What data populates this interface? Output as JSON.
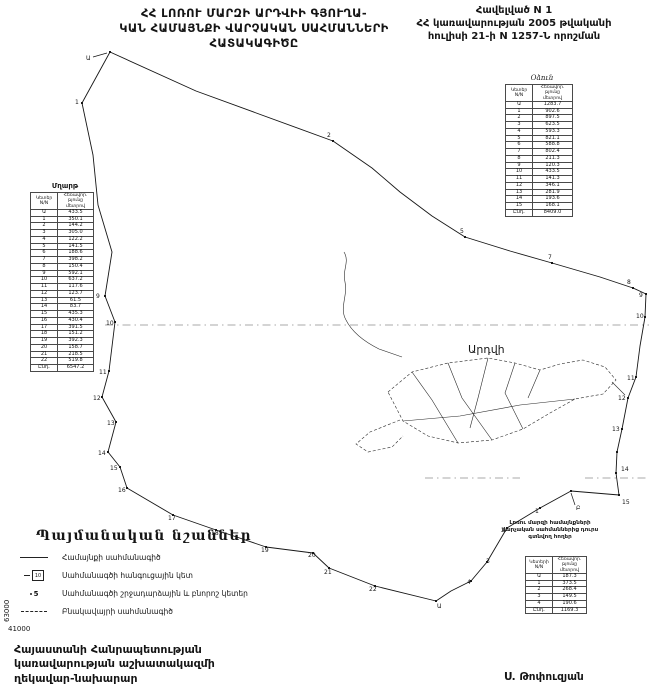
{
  "ink": "#161616",
  "title": {
    "line1": "ՀՀ ԼՈՌՈՒ ՄԱՐԶԻ ԱՐԴՎԻԻ ԳՅՈՒՂԱ-",
    "line2": "ԿԱՆ ՀԱՄԱՅՆՔԻ ՎԱՐՉԱԿԱՆ ՍԱՀՄԱՆՆԵՐԻ",
    "line3": "ՀԱՏԱԿԱԳԻԾԸ"
  },
  "annex": {
    "line1": "Հավելված N 1",
    "line2": "ՀՀ կառավարության 2005 թվականի",
    "line3": "հուլիսի 21-ի N 1257-Ն որոշման"
  },
  "left_table": {
    "title": "Մղարթ",
    "col1_lines": [
      "Կետեր",
      "N/N"
    ],
    "col2_lines": [
      "Հեռավոր.",
      "թյունը",
      "մետրով"
    ],
    "rows": [
      [
        "Ա",
        "433.5"
      ],
      [
        "1",
        "350.1"
      ],
      [
        "2",
        "144.2"
      ],
      [
        "3",
        "305.0"
      ],
      [
        "4",
        "122.2"
      ],
      [
        "5",
        "141.5"
      ],
      [
        "6",
        "188.6"
      ],
      [
        "7",
        "398.2"
      ],
      [
        "8",
        "150.4"
      ],
      [
        "9",
        "592.1"
      ],
      [
        "10",
        "637.2"
      ],
      [
        "11",
        "117.6"
      ],
      [
        "12",
        "123.7"
      ],
      [
        "13",
        "61.5"
      ],
      [
        "14",
        "83.7"
      ],
      [
        "15",
        "435.3"
      ],
      [
        "16",
        "430.4"
      ],
      [
        "17",
        "391.5"
      ],
      [
        "18",
        "151.2"
      ],
      [
        "19",
        "392.3"
      ],
      [
        "20",
        "158.7"
      ],
      [
        "21",
        "218.5"
      ],
      [
        "22",
        "519.8"
      ]
    ],
    "total_label": "Ընդ.",
    "total": "6547.2"
  },
  "right_table": {
    "title": "Օձուն",
    "col1_lines": [
      "Կետեր",
      "N/N"
    ],
    "col2_lines": [
      "Հեռավոր.",
      "թյունը",
      "մետրով"
    ],
    "rows": [
      [
        "Ա",
        "1283.7"
      ],
      [
        "1",
        "902.6"
      ],
      [
        "2",
        "897.5"
      ],
      [
        "3",
        "623.5"
      ],
      [
        "4",
        "593.3"
      ],
      [
        "5",
        "821.1"
      ],
      [
        "6",
        "588.8"
      ],
      [
        "7",
        "802.4"
      ],
      [
        "8",
        "211.3"
      ],
      [
        "9",
        "120.3"
      ],
      [
        "10",
        "433.5"
      ],
      [
        "11",
        "141.3"
      ],
      [
        "12",
        "346.1"
      ],
      [
        "13",
        "281.9"
      ],
      [
        "14",
        "193.6"
      ],
      [
        "15",
        "168.1"
      ]
    ],
    "total_label": "Ընդ.",
    "total": "8409.0"
  },
  "outside_table": {
    "caption_lines": [
      "Լոռու մարզի համայնքների",
      "վարչական սահմաններից դուրս",
      "գտնվող հողեր"
    ],
    "col1_lines": [
      "Կետերի",
      "N/N"
    ],
    "col2_lines": [
      "Հեռավոր.",
      "թյունը",
      "մետրով"
    ],
    "rows": [
      [
        "Ա",
        "187.3"
      ],
      [
        "1",
        "373.5"
      ],
      [
        "2",
        "268.4"
      ],
      [
        "3",
        "149.5"
      ],
      [
        "4",
        "190.6"
      ]
    ],
    "total_label": "Ընդ.",
    "total": "1169.3"
  },
  "legend": {
    "title": "Պայմանական նշաններ",
    "items": [
      {
        "symbol": "solid-line",
        "label": "Համայնքի սահմանագիծ"
      },
      {
        "symbol": "node-box",
        "number": "10",
        "label": "Սահմանագծի հանգուցային կետ"
      },
      {
        "symbol": "turn-point",
        "number": "5",
        "label": "Սահմանագծի շրջադարձային և բնորոշ կետեր"
      },
      {
        "symbol": "dashed-line",
        "label": "Բնակավայրի սահմանագիծ"
      }
    ]
  },
  "footer": {
    "line1": "Հայաստանի Հանրապետության",
    "line2": "կառավարության աշխատակազմի",
    "line3": "ղեկավար-նախարար",
    "signature": "Ս. Թոփուզյան"
  },
  "grid_labels": {
    "y": "63000",
    "x": "41000"
  },
  "map": {
    "settlement_label": "Արդվի",
    "settlement_label_pos": [
      468,
      353
    ],
    "boundary": [
      [
        110,
        52
      ],
      [
        196,
        91
      ],
      [
        333,
        141
      ],
      [
        372,
        168
      ],
      [
        400,
        192
      ],
      [
        432,
        216
      ],
      [
        465,
        237
      ],
      [
        510,
        251
      ],
      [
        552,
        263
      ],
      [
        600,
        277
      ],
      [
        633,
        288
      ],
      [
        646,
        294
      ],
      [
        645,
        317
      ],
      [
        640,
        346
      ],
      [
        636,
        377
      ],
      [
        628,
        398
      ],
      [
        622,
        429
      ],
      [
        617,
        452
      ],
      [
        616,
        473
      ],
      [
        619,
        495
      ],
      [
        571,
        491
      ],
      [
        540,
        508
      ],
      [
        507,
        528
      ],
      [
        497,
        545
      ],
      [
        487,
        562
      ],
      [
        471,
        581
      ],
      [
        451,
        591
      ],
      [
        436,
        601
      ],
      [
        375,
        586
      ],
      [
        329,
        568
      ],
      [
        313,
        553
      ],
      [
        266,
        547
      ],
      [
        216,
        530
      ],
      [
        173,
        515
      ],
      [
        127,
        488
      ],
      [
        120,
        467
      ],
      [
        108,
        452
      ],
      [
        116,
        422
      ],
      [
        102,
        397
      ],
      [
        109,
        371
      ],
      [
        115,
        322
      ],
      [
        105,
        296
      ],
      [
        112,
        252
      ],
      [
        98,
        205
      ],
      [
        93,
        155
      ],
      [
        82,
        103
      ],
      [
        110,
        52
      ]
    ],
    "cluster_paths": [
      {
        "d": "M345,282 C342,270 350,262 344,252 M345,282 C348,296 339,308 346,320 C352,332 363,341 379,349 L402,357",
        "dashed": false
      },
      {
        "d": "M388,392 L412,372 448,363 488,358 515,363 540,370 560,364 583,360 605,367 616,380 603,394 575,399 550,413 523,429 492,440 458,443 428,436 403,421 Z",
        "dashed": true
      },
      {
        "d": "M412,372 L432,400 458,443 M448,363 L462,398 492,440 M488,358 L478,398 470,428 M515,363 L505,393 523,429 M540,370 L528,398 M403,421 L460,416 520,405 575,399 M612,382 L625,395",
        "dashed": false
      },
      {
        "d": "M400,420 L370,432 356,444 368,452 392,447 403,436",
        "dashed": true
      }
    ],
    "grid_segments": [
      [
        105,
        325,
        649,
        325
      ],
      [
        425,
        478,
        520,
        478
      ],
      [
        585,
        478,
        649,
        478
      ]
    ],
    "leader_lines": [
      [
        93,
        57,
        107,
        53
      ],
      [
        575,
        505,
        571,
        493
      ]
    ],
    "dots": [
      [
        110,
        52
      ],
      [
        82,
        103
      ],
      [
        333,
        141
      ],
      [
        465,
        237
      ],
      [
        552,
        263
      ],
      [
        633,
        288
      ],
      [
        646,
        294
      ],
      [
        645,
        317
      ],
      [
        636,
        377
      ],
      [
        628,
        398
      ],
      [
        622,
        429
      ],
      [
        617,
        452
      ],
      [
        616,
        473
      ],
      [
        619,
        495
      ],
      [
        571,
        491
      ],
      [
        540,
        508
      ],
      [
        507,
        528
      ],
      [
        487,
        562
      ],
      [
        471,
        581
      ],
      [
        436,
        601
      ],
      [
        375,
        586
      ],
      [
        329,
        568
      ],
      [
        313,
        553
      ],
      [
        266,
        547
      ],
      [
        216,
        530
      ],
      [
        173,
        515
      ],
      [
        127,
        488
      ],
      [
        120,
        467
      ],
      [
        108,
        452
      ],
      [
        116,
        422
      ],
      [
        102,
        397
      ],
      [
        109,
        371
      ],
      [
        115,
        322
      ],
      [
        105,
        296
      ]
    ],
    "point_labels": [
      {
        "t": "Ա",
        "x": 86,
        "y": 60
      },
      {
        "t": "1",
        "x": 75,
        "y": 104
      },
      {
        "t": "2",
        "x": 327,
        "y": 137
      },
      {
        "t": "5",
        "x": 460,
        "y": 233
      },
      {
        "t": "7",
        "x": 548,
        "y": 259
      },
      {
        "t": "8",
        "x": 627,
        "y": 284
      },
      {
        "t": "9",
        "x": 639,
        "y": 297
      },
      {
        "t": "10",
        "x": 636,
        "y": 318
      },
      {
        "t": "11",
        "x": 627,
        "y": 380
      },
      {
        "t": "12",
        "x": 618,
        "y": 400
      },
      {
        "t": "13",
        "x": 612,
        "y": 431
      },
      {
        "t": "14",
        "x": 621,
        "y": 471
      },
      {
        "t": "15",
        "x": 622,
        "y": 504
      },
      {
        "t": "Բ",
        "x": 576,
        "y": 510
      },
      {
        "t": "1",
        "x": 535,
        "y": 513
      },
      {
        "t": "2",
        "x": 501,
        "y": 532
      },
      {
        "t": "3",
        "x": 486,
        "y": 563
      },
      {
        "t": "4",
        "x": 467,
        "y": 584
      },
      {
        "t": "Ա",
        "x": 437,
        "y": 608
      },
      {
        "t": "22",
        "x": 369,
        "y": 591
      },
      {
        "t": "21",
        "x": 324,
        "y": 574
      },
      {
        "t": "20",
        "x": 308,
        "y": 557
      },
      {
        "t": "19",
        "x": 261,
        "y": 552
      },
      {
        "t": "18",
        "x": 211,
        "y": 535
      },
      {
        "t": "17",
        "x": 168,
        "y": 520
      },
      {
        "t": "16",
        "x": 118,
        "y": 492
      },
      {
        "t": "15",
        "x": 110,
        "y": 470
      },
      {
        "t": "14",
        "x": 98,
        "y": 455
      },
      {
        "t": "13",
        "x": 107,
        "y": 425
      },
      {
        "t": "12",
        "x": 93,
        "y": 400
      },
      {
        "t": "11",
        "x": 99,
        "y": 374
      },
      {
        "t": "10",
        "x": 106,
        "y": 325
      },
      {
        "t": "9",
        "x": 96,
        "y": 298
      }
    ]
  }
}
